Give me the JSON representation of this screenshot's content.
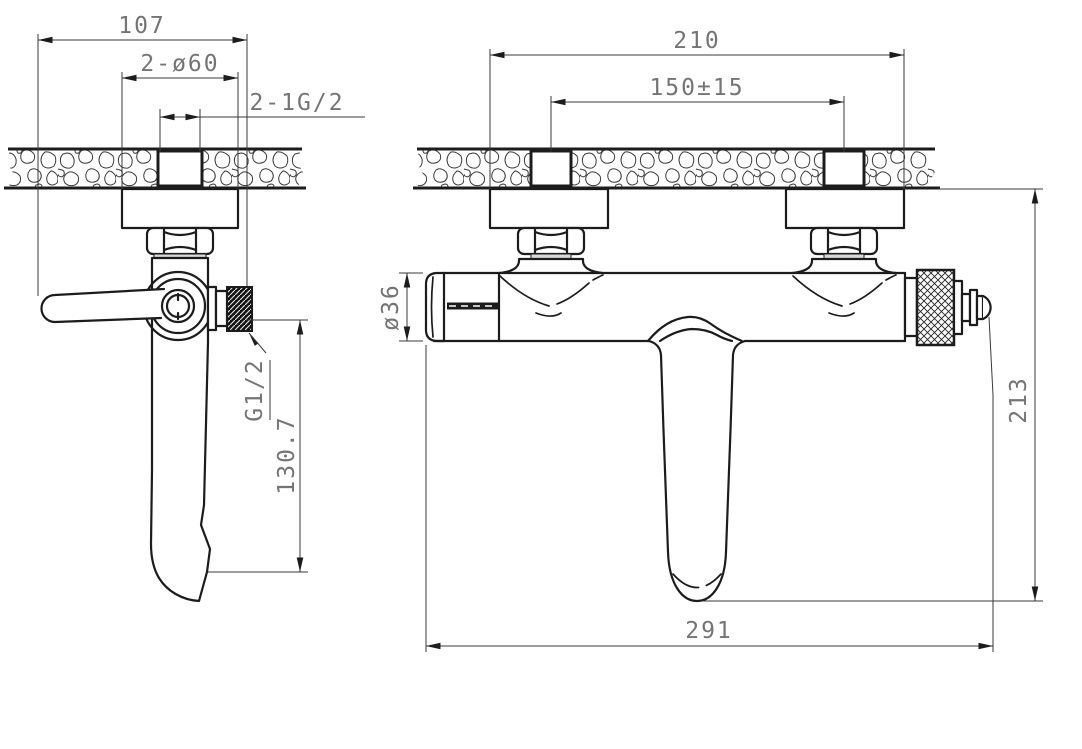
{
  "drawing": {
    "title": "Wall-mounted bath mixer — installation dimension drawing",
    "type": "technical-drawing",
    "colors": {
      "line": "#1c1c1c",
      "dimension_text": "#757575",
      "background": "#ffffff"
    },
    "side_view": {
      "dim_overall_depth": "107",
      "dim_escutcheon_diameter": "2-ø60",
      "dim_inlet_thread": "2-1G/2",
      "label_outlet_thread": "G1/2",
      "dim_spout_drop": "130.7"
    },
    "front_view": {
      "dim_flange_span": "210",
      "dim_inlet_centers": "150±15",
      "dim_body_diameter": "ø36",
      "dim_height_below_wall": "213",
      "dim_overall_length": "291"
    }
  }
}
